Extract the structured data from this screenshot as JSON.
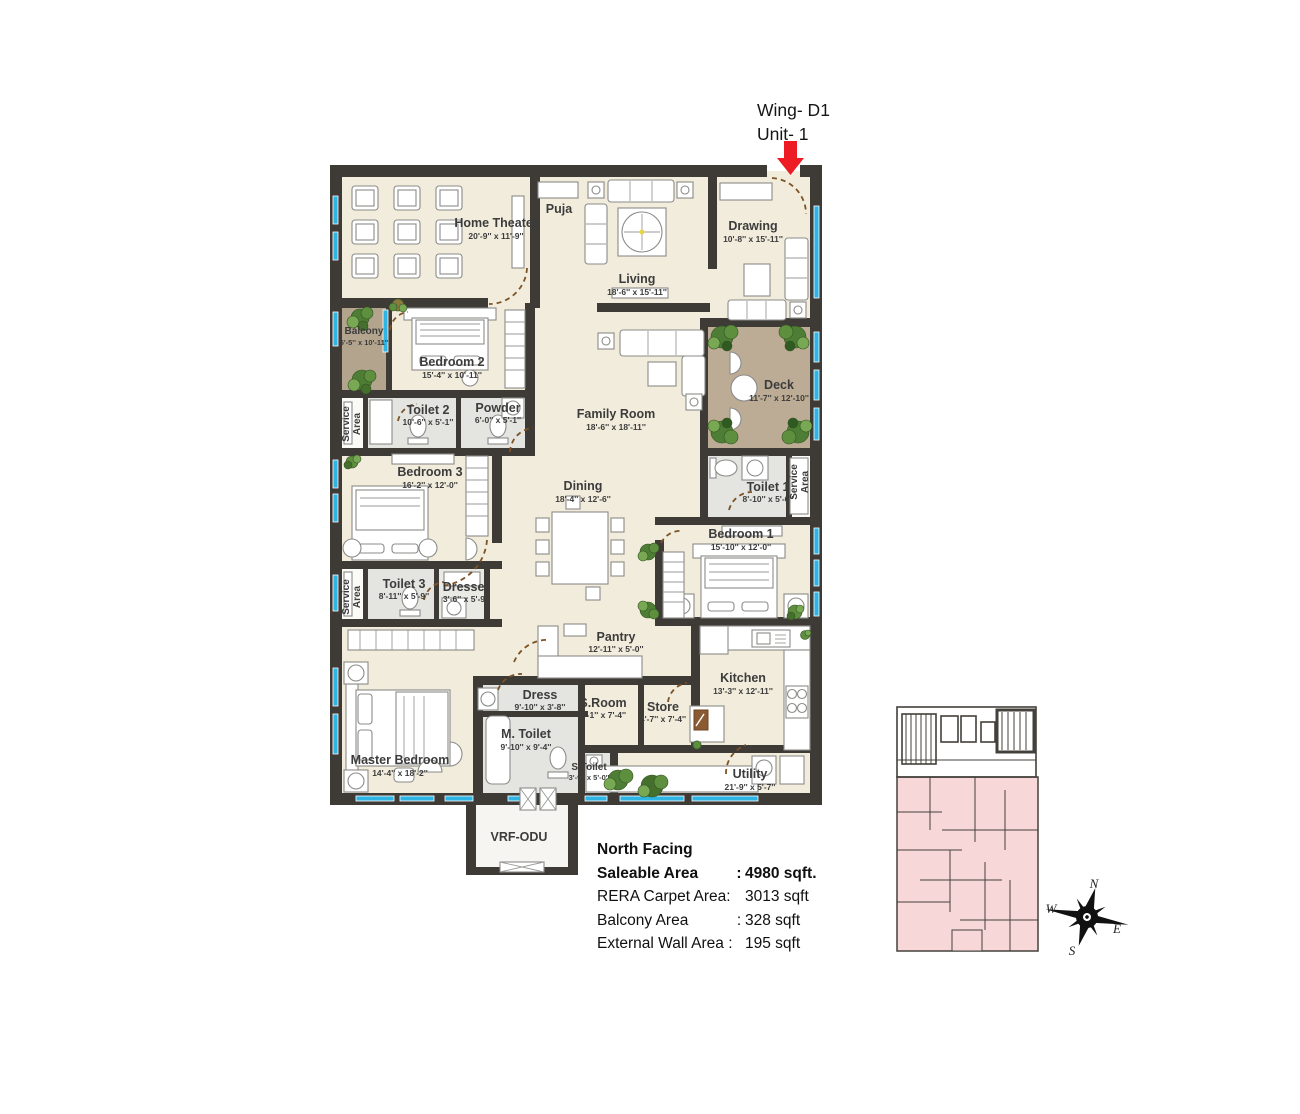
{
  "annotation": {
    "wing": "Wing- D1",
    "unit": "Unit- 1"
  },
  "info": {
    "heading": "North Facing",
    "rows": [
      {
        "label": "Saleable Area",
        "sep": ":",
        "value": "4980 sqft.",
        "bold": true
      },
      {
        "label": "RERA Carpet Area:",
        "sep": "",
        "value": "3013 sqft",
        "bold": false
      },
      {
        "label": "Balcony Area",
        "sep": ":",
        "value": "328 sqft",
        "bold": false
      },
      {
        "label": "External Wall Area :",
        "sep": "",
        "value": "195 sqft",
        "bold": false
      }
    ]
  },
  "rooms": [
    {
      "name": "Home Theater",
      "dims": "20'-9'' x 11'-9''"
    },
    {
      "name": "Puja",
      "dims": ""
    },
    {
      "name": "Living",
      "dims": "18'-6'' x 15'-11''"
    },
    {
      "name": "Drawing",
      "dims": "10'-8'' x 15'-11''"
    },
    {
      "name": "Balcony",
      "dims": "5'-5'' x 10'-11''"
    },
    {
      "name": "Bedroom 2",
      "dims": "15'-4'' x 10'-11''"
    },
    {
      "name": "Toilet 2",
      "dims": "10'-6'' x 5'-1''"
    },
    {
      "name": "Powder",
      "dims": "6'-0'' x 5'-1''"
    },
    {
      "name": "Family Room",
      "dims": "18'-6'' x 18'-11''"
    },
    {
      "name": "Deck",
      "dims": "11'-7'' x 12'-10''"
    },
    {
      "name": "Toilet 1",
      "dims": "8'-10'' x 5'-6''"
    },
    {
      "name": "Bedroom 3",
      "dims": "16'-2'' x 12'-0''"
    },
    {
      "name": "Dining",
      "dims": "18'-4'' x 12'-6''"
    },
    {
      "name": "Bedroom 1",
      "dims": "15'-10'' x 12'-0''"
    },
    {
      "name": "Toilet 3",
      "dims": "8'-11'' x 5'-9''"
    },
    {
      "name": "Dresser",
      "dims": "3'-6'' x 5'-9''"
    },
    {
      "name": "Pantry",
      "dims": "12'-11'' x 5'-0''"
    },
    {
      "name": "Kitchen",
      "dims": "13'-3'' x 12'-11''"
    },
    {
      "name": "Master Bedroom",
      "dims": "14'-4'' x 18'-2''"
    },
    {
      "name": "Dress",
      "dims": "9'-10'' x 3'-8''"
    },
    {
      "name": "M. Toilet",
      "dims": "9'-10'' x 9'-4''"
    },
    {
      "name": "S.Room",
      "dims": "7'-1'' x 7'-4''"
    },
    {
      "name": "Store",
      "dims": "4'-7'' x 7'-4''"
    },
    {
      "name": "S.Toilet",
      "dims": "3'-9'' x 5'-0''"
    },
    {
      "name": "Utility",
      "dims": "21'-9'' x 5'-7''"
    },
    {
      "name": "VRF-ODU",
      "dims": ""
    }
  ],
  "service": {
    "line1": "Service",
    "line2": "Area"
  },
  "compass": {
    "n": "N",
    "e": "E",
    "s": "S",
    "w": "W"
  },
  "colors": {
    "floor": "#f2ecdc",
    "wall": "#3e3b37",
    "grayFloor": "#e4e4e0",
    "balcony": "#b3a48e",
    "deck": "#bcac95",
    "window": "#2eb5e4",
    "keyplanPink": "#f8d7d8",
    "arrowRed": "#ec1b24",
    "plant": "#4e7d35"
  }
}
